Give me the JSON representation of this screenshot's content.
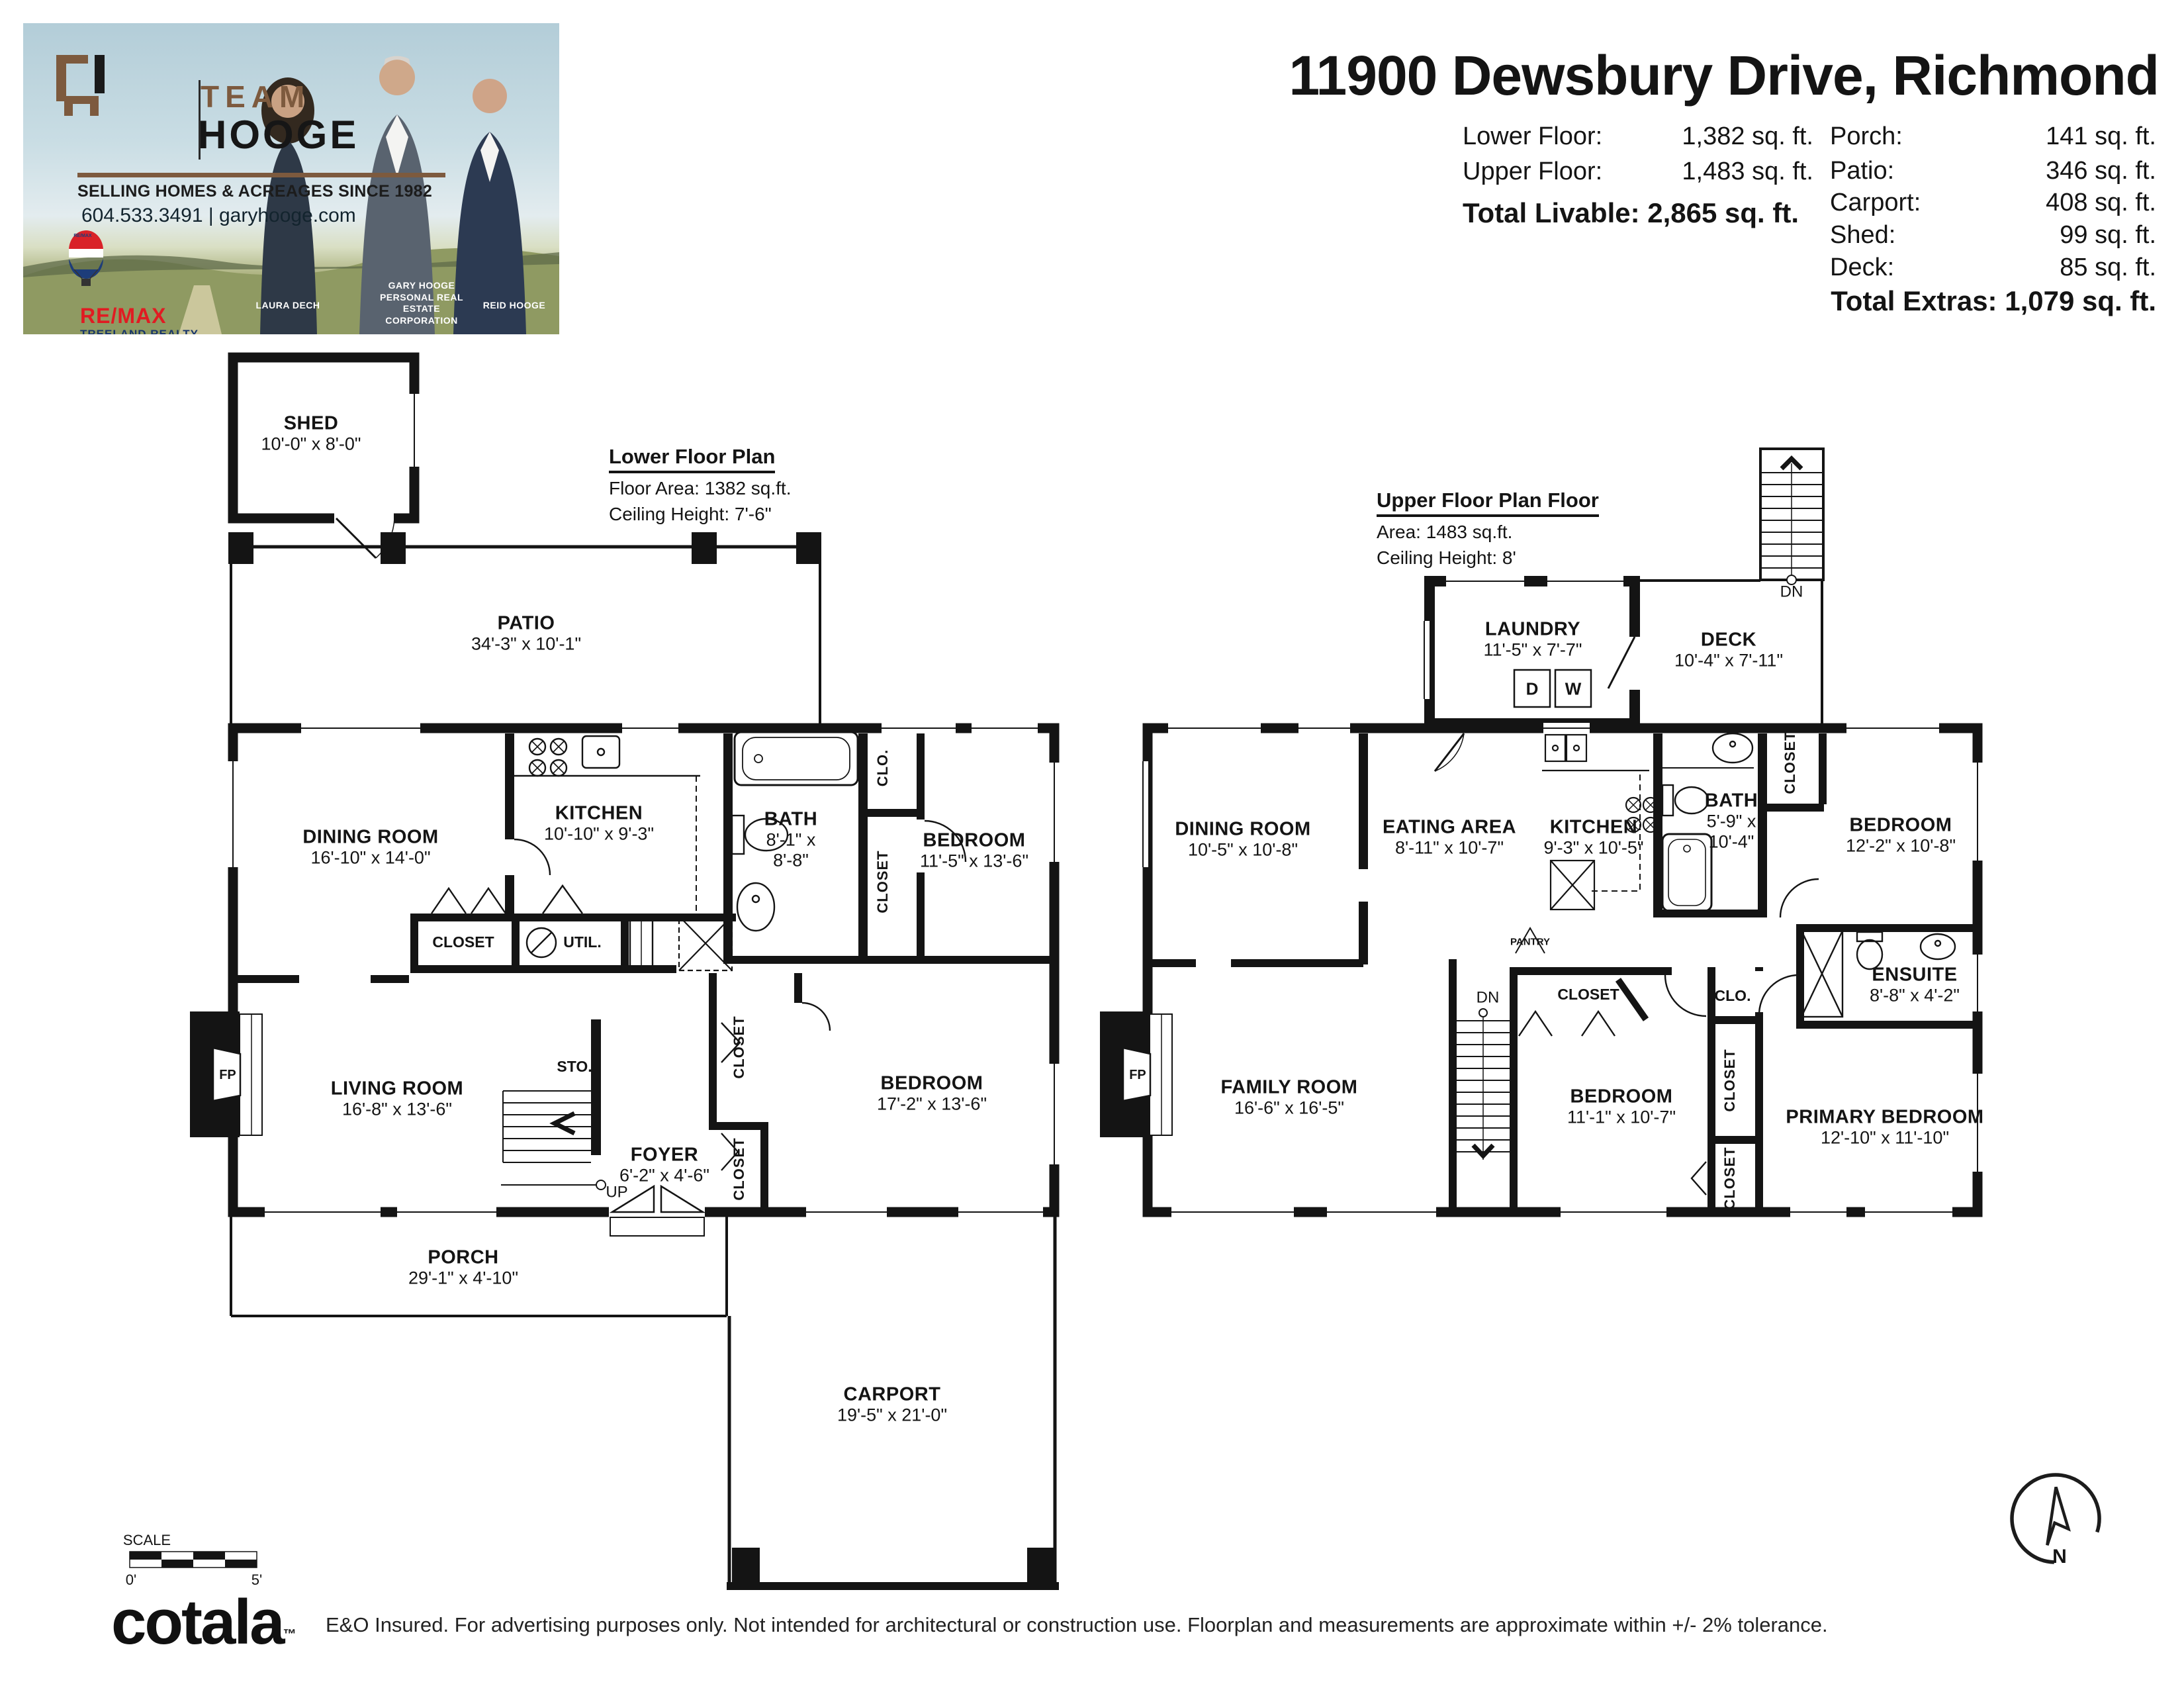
{
  "header": {
    "title": "11900 Dewsbury Drive, Richmond",
    "stats_left": [
      {
        "label": "Lower Floor:",
        "value": "1,382 sq. ft."
      },
      {
        "label": "Upper Floor:",
        "value": "1,483 sq. ft."
      }
    ],
    "total_livable": {
      "label": "Total Livable:",
      "value": "2,865 sq. ft."
    },
    "stats_right": [
      {
        "label": "Porch:",
        "value": "141 sq. ft."
      },
      {
        "label": "Patio:",
        "value": "346 sq. ft."
      },
      {
        "label": "Carport:",
        "value": "408 sq. ft."
      },
      {
        "label": "Shed:",
        "value": "99 sq. ft."
      },
      {
        "label": "Deck:",
        "value": "85 sq. ft."
      }
    ],
    "total_extras": {
      "label": "Total Extras:",
      "value": "1,079 sq. ft."
    }
  },
  "brand": {
    "team": "TEAM",
    "hooge": "HOOGE",
    "tagline": "SELLING HOMES & ACREAGES SINCE 1982",
    "contact": "604.533.3491 | garyhooge.com",
    "remax_wordmark": "RE/MAX",
    "remax_office": "TREELAND REALTY",
    "remax_balloon_text": "RE/MAX",
    "office_disclaimer": "Each office independently owned and operated",
    "people": [
      {
        "name": "LAURA DECH"
      },
      {
        "name": "GARY HOOGE PERSONAL REAL ESTATE CORPORATION"
      },
      {
        "name": "REID HOOGE"
      }
    ]
  },
  "lower_floor": {
    "heading": "Lower Floor Plan",
    "area_line": "Floor Area: 1382 sq.ft.",
    "ceiling_line": "Ceiling Height: 7'-6\"",
    "fp_label": "FP",
    "rooms": {
      "shed": {
        "name": "SHED",
        "dims": "10'-0\" x 8'-0\""
      },
      "patio": {
        "name": "PATIO",
        "dims": "34'-3\" x 10'-1\""
      },
      "dining": {
        "name": "DINING ROOM",
        "dims": "16'-10\" x 14'-0\""
      },
      "kitchen": {
        "name": "KITCHEN",
        "dims": "10'-10\" x 9'-3\""
      },
      "bath": {
        "name": "BATH",
        "dims": "8'-1\" x",
        "dims2": "8'-8\""
      },
      "bedroom_top": {
        "name": "BEDROOM",
        "dims": "11'-5\" x 13'-6\""
      },
      "closet_mid": {
        "name": "CLOSET"
      },
      "util": {
        "name": "UTIL."
      },
      "clo": {
        "name": "CLO."
      },
      "closet_bed": {
        "name": "CLOSET"
      },
      "living": {
        "name": "LIVING ROOM",
        "dims": "16'-8\" x 13'-6\""
      },
      "sto": {
        "name": "STO."
      },
      "foyer": {
        "name": "FOYER",
        "dims": "6'-2\" x 4'-6\"",
        "up": "UP"
      },
      "closet_foyer_top": {
        "name": "CLOSET"
      },
      "closet_foyer_bottom": {
        "name": "CLOSET"
      },
      "bedroom_bottom": {
        "name": "BEDROOM",
        "dims": "17'-2\" x 13'-6\""
      },
      "porch": {
        "name": "PORCH",
        "dims": "29'-1\" x 4'-10\""
      },
      "carport": {
        "name": "CARPORT",
        "dims": "19'-5\" x 21'-0\""
      }
    }
  },
  "upper_floor": {
    "heading": "Upper Floor Plan Floor",
    "area_line": "Area: 1483 sq.ft.",
    "ceiling_line": "Ceiling Height: 8'",
    "dn": "DN",
    "fp_label": "FP",
    "rooms": {
      "laundry": {
        "name": "LAUNDRY",
        "dims": "11'-5\" x 7'-7\"",
        "d": "D",
        "w": "W"
      },
      "deck": {
        "name": "DECK",
        "dims": "10'-4\" x 7'-11\""
      },
      "dining": {
        "name": "DINING ROOM",
        "dims": "10'-5\" x 10'-8\""
      },
      "eating": {
        "name": "EATING AREA",
        "dims": "8'-11\" x 10'-7\""
      },
      "kitchen": {
        "name": "KITCHEN",
        "dims": "9'-3\" x 10'-5\""
      },
      "pantry": {
        "name": "PANTRY"
      },
      "bath": {
        "name": "BATH",
        "dims": "5'-9\" x",
        "dims2": "10'-4\""
      },
      "closet_bed": {
        "name": "CLOSET"
      },
      "bedroom_top": {
        "name": "BEDROOM",
        "dims": "12'-2\" x 10'-8\""
      },
      "ensuite": {
        "name": "ENSUITE",
        "dims": "8'-8\" x 4'-2\""
      },
      "family": {
        "name": "FAMILY ROOM",
        "dims": "16'-6\" x 16'-5\""
      },
      "closet_bed2": {
        "name": "CLOSET"
      },
      "clo": {
        "name": "CLO."
      },
      "bedroom_bottom": {
        "name": "BEDROOM",
        "dims": "11'-1\" x 10'-7\""
      },
      "closet_mid": {
        "name": "CLOSET"
      },
      "closet_bottom": {
        "name": "CLOSET"
      },
      "primary": {
        "name": "PRIMARY BEDROOM",
        "dims": "12'-10\" x 11'-10\""
      }
    }
  },
  "footer": {
    "scale_label": "SCALE",
    "scale_start": "0'",
    "scale_end": "5'",
    "logo": "cotala",
    "logo_tm": "™",
    "disclaimer": "E&O Insured. For advertising purposes only. Not intended for architectural or construction use. Floorplan and measurements are approximate within +/- 2% tolerance.",
    "compass_n": "N"
  },
  "colors": {
    "wall": "#141414",
    "brand_brown": "#7d5a3e",
    "remax_red": "#e11b22",
    "remax_blue": "#17356b"
  }
}
